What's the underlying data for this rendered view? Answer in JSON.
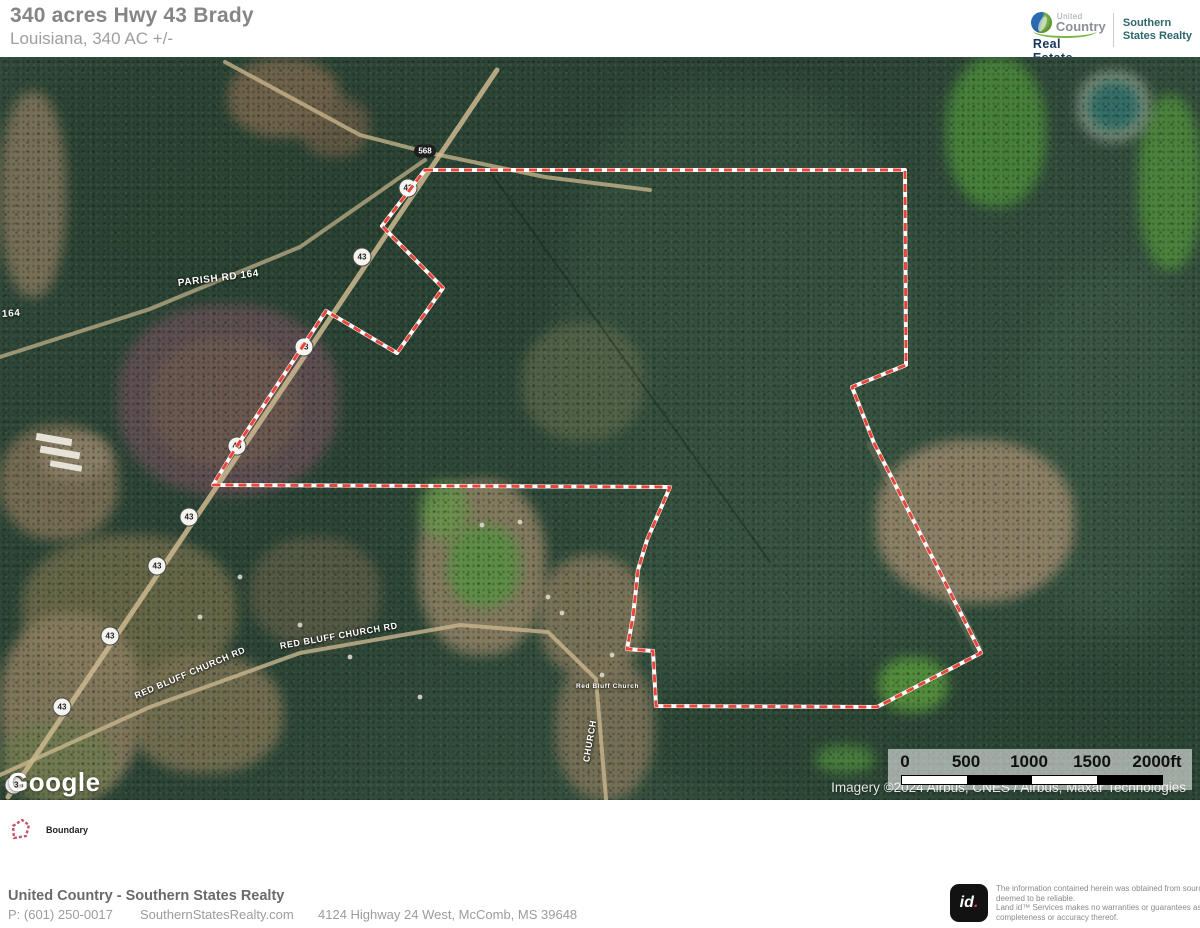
{
  "header": {
    "title": "340 acres Hwy 43 Brady",
    "subtitle": "Louisiana, 340 AC +/-",
    "brand": {
      "united": "United",
      "country": "Country",
      "real_estate": "Real Estate",
      "agency_line1": "Southern",
      "agency_line2": "States Realty"
    }
  },
  "map": {
    "google_logo": "Google",
    "attribution": "Imagery ©2024 Airbus, CNES / Airbus, Maxar Technologies",
    "scale_ticks": [
      "0",
      "500",
      "1000",
      "1500",
      "2000ft"
    ],
    "boundary": {
      "color": "#e8463b",
      "casing": "#ffffff",
      "points": [
        [
          425,
          113
        ],
        [
          905,
          113
        ],
        [
          906,
          308
        ],
        [
          852,
          330
        ],
        [
          874,
          386
        ],
        [
          981,
          596
        ],
        [
          877,
          650
        ],
        [
          656,
          649
        ],
        [
          653,
          594
        ],
        [
          627,
          592
        ],
        [
          633,
          560
        ],
        [
          638,
          513
        ],
        [
          647,
          483
        ],
        [
          670,
          430
        ],
        [
          213,
          428
        ],
        [
          237,
          389
        ],
        [
          303,
          289
        ],
        [
          326,
          254
        ],
        [
          397,
          296
        ],
        [
          443,
          231
        ],
        [
          382,
          169
        ]
      ]
    },
    "shields": {
      "route_568": {
        "label": "568",
        "x": 425,
        "y": 94
      },
      "route_43": {
        "label": "43",
        "positions": [
          [
            408,
            131
          ],
          [
            362,
            200
          ],
          [
            304,
            290
          ],
          [
            237,
            389
          ],
          [
            189,
            460
          ],
          [
            157,
            509
          ],
          [
            110,
            579
          ],
          [
            62,
            650
          ],
          [
            14,
            728
          ]
        ]
      }
    },
    "road_labels": [
      {
        "text": "PARISH RD 164",
        "x": 178,
        "y": 221,
        "rot": -7,
        "size": 10
      },
      {
        "text": "164",
        "x": 2,
        "y": 252,
        "rot": -4,
        "size": 10
      },
      {
        "text": "RED BLUFF CHURCH RD",
        "x": 280,
        "y": 584,
        "rot": -10,
        "size": 9
      },
      {
        "text": "RED BLUFF CHURCH RD",
        "x": 135,
        "y": 634,
        "rot": -23,
        "size": 9
      },
      {
        "text": "CHURCH",
        "x": 586,
        "y": 700,
        "rot": -80,
        "size": 9
      },
      {
        "text": "Red Bluff Church",
        "x": 576,
        "y": 626,
        "rot": 0,
        "size": 6.5
      }
    ]
  },
  "legend": {
    "boundary_label": "Boundary"
  },
  "footer": {
    "company": "United Country - Southern States Realty",
    "phone": "P: (601) 250-0017",
    "website": "SouthernStatesRealty.com",
    "address": "4124 Highway 24 West, McComb, MS 39648",
    "land_id_logo": "id",
    "land_id_dot": ".",
    "disclaimer_lines": [
      "The information contained herein was obtained from sources",
      "deemed to be reliable.",
      " Land id™ Services makes no warranties or guarantees as to the",
      "completeness or accuracy thereof."
    ]
  }
}
